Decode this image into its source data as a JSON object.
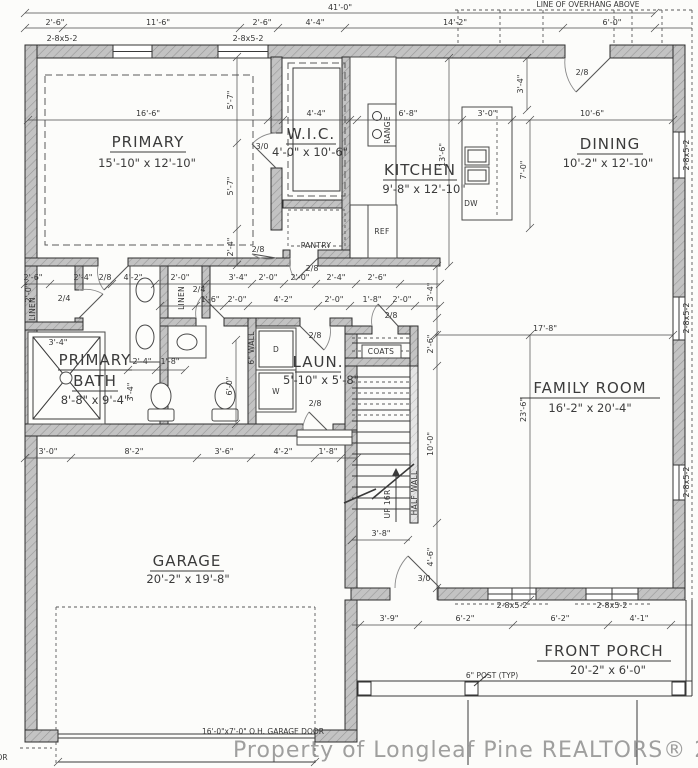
{
  "watermark": "Property of Longleaf Pine REALTORS® 2020",
  "rooms": {
    "primary": {
      "name": "PRIMARY",
      "size": "15'-10\" x 12'-10\""
    },
    "wic": {
      "name": "W.I.C.",
      "size": "4'-0\" x 10'-6\""
    },
    "kitchen": {
      "name": "KITCHEN",
      "size": "9'-8\" x 12'-10\""
    },
    "dining": {
      "name": "DINING",
      "size": "10'-2\" x 12'-10\""
    },
    "primary_bath": {
      "name1": "PRIMARY",
      "name2": "BATH",
      "size": "8'-8\" x 9'-4\""
    },
    "laundry": {
      "name": "LAUN.",
      "size": "5'-10\" x 5'-8\""
    },
    "family": {
      "name": "FAMILY ROOM",
      "size": "16'-2\" x 20'-4\""
    },
    "garage": {
      "name": "GARAGE",
      "size": "20'-2\" x 19'-8\""
    },
    "porch": {
      "name": "FRONT PORCH",
      "size": "20'-2\" x 6'-0\""
    }
  },
  "fixtures": {
    "range": "RANGE",
    "ref": "REF",
    "dw": "DW",
    "pantry": "PANTRY",
    "linen1": "LINEN",
    "linen2": "LINEN",
    "coats": "COATS",
    "dryer": "D",
    "washer": "W",
    "six_wall": "6\" WALL",
    "half_wall": "HALF WALL",
    "up": "UP 16R"
  },
  "notes": {
    "overhang": "LINE OF OVERHANG ABOVE",
    "garage_door": "16'-0\"x7'-0\" O.H. GARAGE DOOR",
    "post": "6\" POST (TYP)",
    "fragment": "OR"
  },
  "doors": {
    "d30": "3/0",
    "d28": "2/8",
    "d24": "2/4"
  },
  "windows": {
    "w2852": "2-8x5-2"
  },
  "dims": {
    "overall": "41'-0\"",
    "ft2_6": "2'-6\"",
    "ft11_6": "11'-6\"",
    "ft4_4": "4'-4\"",
    "ft14_2": "14'-2\"",
    "ft6_0": "6'-0\"",
    "ft16_6": "16'-6\"",
    "ft5_7": "5'-7\"",
    "ft2_4": "2'-4\"",
    "ft6_8": "6'-8\"",
    "ft13_6": "13'-6\"",
    "ft3_0": "3'-0\"",
    "ft7_0": "7'-0\"",
    "ft10_6": "10'-6\"",
    "ft3_4": "3'-4\"",
    "ft4_2": "4'-2\"",
    "ft2_0": "2'-0\"",
    "ft1_6": "1'-6\"",
    "ft1_8": "1'-8\"",
    "ft17_8": "17'-8\"",
    "ft23_6": "23'-6\"",
    "ft10_0": "10'-0\"",
    "ft3_8": "3'-8\"",
    "ft4_6": "4'-6\"",
    "ft8_2": "8'-2\"",
    "ft3_6": "3'-6\"",
    "ft3_9": "3'-9\"",
    "ft6_2": "6'-2\"",
    "ft4_1": "4'-1\""
  }
}
